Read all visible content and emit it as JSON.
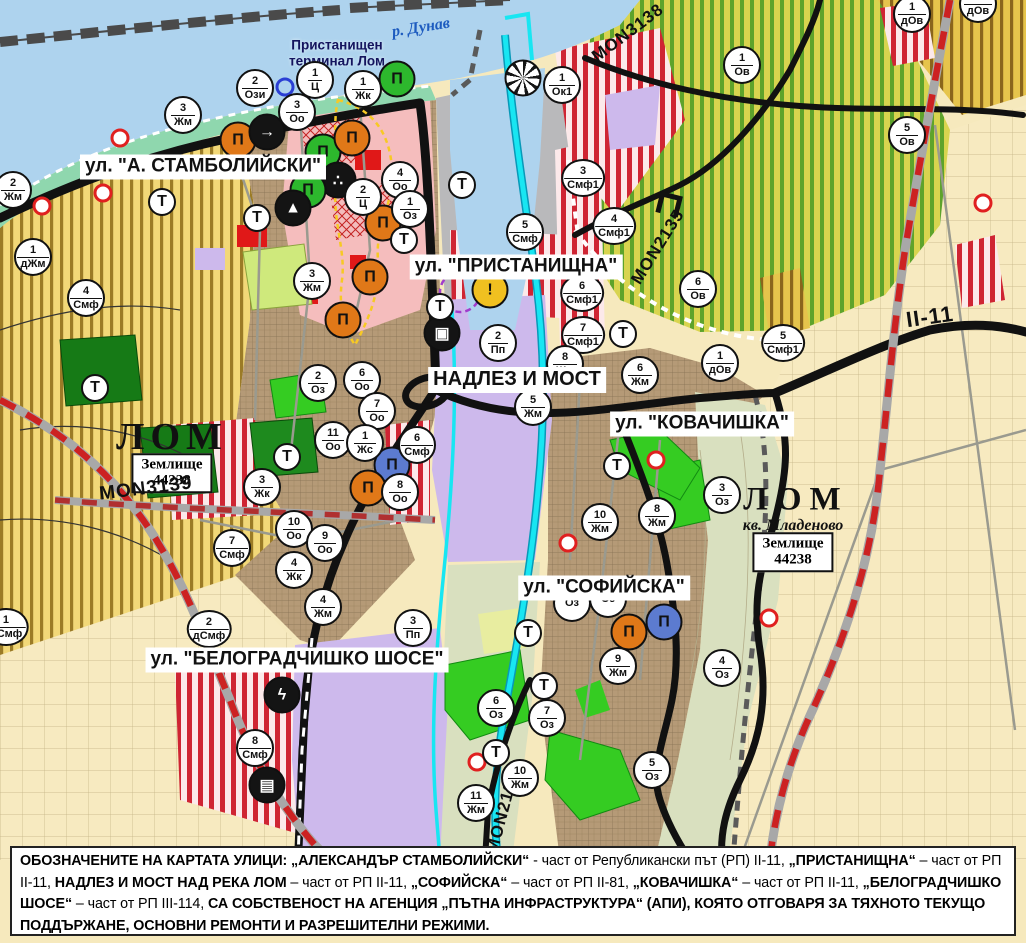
{
  "map_title": "Устройствен план – гр. Лом",
  "rivers": {
    "danube_label": "р. Дунав",
    "port_label": "Пристанищен\nтерминал Лом"
  },
  "street_labels": [
    {
      "text": "ул. \"А. СТАМБОЛИЙСКИ\"",
      "x": 203,
      "y": 167,
      "fs": 19
    },
    {
      "text": "ул. \"ПРИСТАНИЩНА\"",
      "x": 516,
      "y": 267,
      "fs": 19
    },
    {
      "text": "НАДЛЕЗ И МОСТ",
      "x": 517,
      "y": 380,
      "fs": 20
    },
    {
      "text": "ул. \"КОВАЧИШКА\"",
      "x": 702,
      "y": 424,
      "fs": 19
    },
    {
      "text": "ул. \"СОФИЙСКА\"",
      "x": 604,
      "y": 588,
      "fs": 19
    },
    {
      "text": "ул. \"БЕЛОГРАДЧИШКО ШОСЕ\"",
      "x": 297,
      "y": 660,
      "fs": 19
    }
  ],
  "road_labels": [
    {
      "text": "MON3138",
      "x": 628,
      "y": 33,
      "rot": -37,
      "fs": 17
    },
    {
      "text": "MON3139",
      "x": 146,
      "y": 489,
      "rot": -7,
      "fs": 19
    },
    {
      "text": "MON2135",
      "x": 658,
      "y": 247,
      "rot": -58,
      "fs": 17
    },
    {
      "text": "MON2136",
      "x": 503,
      "y": 812,
      "rot": -75,
      "fs": 17
    },
    {
      "text": "II-11",
      "x": 930,
      "y": 317,
      "rot": -8,
      "fs": 22
    }
  ],
  "place_labels": {
    "cities": [
      {
        "text": "ЛОМ",
        "x": 172,
        "y": 437,
        "fs": 38,
        "ls": 6
      },
      {
        "text": "ЛОМ",
        "x": 796,
        "y": 500,
        "fs": 33,
        "ls": 8
      }
    ],
    "districts": [
      {
        "text": "кв. Младеново",
        "x": 793,
        "y": 526,
        "fs": 16
      }
    ],
    "land_boxes": [
      {
        "line1": "Землище",
        "line2": "44238",
        "x": 172,
        "y": 473
      },
      {
        "line1": "Землище",
        "line2": "44238",
        "x": 793,
        "y": 552
      }
    ],
    "river": {
      "x": 421,
      "y": 28,
      "rot": -9,
      "fs": 16
    },
    "port": {
      "x": 337,
      "y": 53
    }
  },
  "zone_markers": [
    [
      255,
      88,
      "2",
      "Ози"
    ],
    [
      315,
      80,
      "1",
      "Ц"
    ],
    [
      297,
      112,
      "3",
      "Оо"
    ],
    [
      363,
      89,
      "1",
      "Жк"
    ],
    [
      562,
      85,
      "1",
      "Ок1"
    ],
    [
      742,
      65,
      "1",
      "Ов"
    ],
    [
      912,
      14,
      "1",
      "дОв"
    ],
    [
      978,
      4,
      "1",
      "дОв"
    ],
    [
      183,
      115,
      "3",
      "Жм"
    ],
    [
      13,
      190,
      "2",
      "Жм"
    ],
    [
      33,
      257,
      "1",
      "дЖм"
    ],
    [
      312,
      281,
      "3",
      "Жм"
    ],
    [
      907,
      135,
      "5",
      "Ов"
    ],
    [
      400,
      180,
      "4",
      "Оо"
    ],
    [
      363,
      197,
      "2",
      "Ц"
    ],
    [
      410,
      209,
      "1",
      "Оз"
    ],
    [
      525,
      232,
      "5",
      "Смф"
    ],
    [
      583,
      178,
      "3",
      "Смф1"
    ],
    [
      614,
      226,
      "4",
      "Смф1"
    ],
    [
      582,
      293,
      "6",
      "Смф1"
    ],
    [
      583,
      335,
      "7",
      "Смф1"
    ],
    [
      698,
      289,
      "6",
      "Ов"
    ],
    [
      720,
      363,
      "1",
      "дОв"
    ],
    [
      783,
      343,
      "5",
      "Смф1"
    ],
    [
      318,
      383,
      "2",
      "Оз"
    ],
    [
      362,
      380,
      "6",
      "Оо"
    ],
    [
      377,
      411,
      "7",
      "Оо"
    ],
    [
      333,
      440,
      "11",
      "Оо"
    ],
    [
      365,
      443,
      "1",
      "Жс"
    ],
    [
      417,
      445,
      "6",
      "Смф"
    ],
    [
      400,
      492,
      "8",
      "Оо"
    ],
    [
      262,
      487,
      "3",
      "Жк"
    ],
    [
      294,
      529,
      "10",
      "Оо"
    ],
    [
      325,
      543,
      "9",
      "Оо"
    ],
    [
      294,
      570,
      "4",
      "Жк"
    ],
    [
      323,
      607,
      "4",
      "Жм"
    ],
    [
      209,
      629,
      "2",
      "дСмф"
    ],
    [
      413,
      628,
      "3",
      "Пп"
    ],
    [
      255,
      748,
      "8",
      "Смф"
    ],
    [
      86,
      298,
      "4",
      "Смф"
    ],
    [
      232,
      548,
      "7",
      "Смф"
    ],
    [
      6,
      627,
      "1",
      "дСмф"
    ],
    [
      498,
      343,
      "2",
      "Пп"
    ],
    [
      533,
      407,
      "5",
      "Жм"
    ],
    [
      565,
      364,
      "8",
      "Жм"
    ],
    [
      640,
      375,
      "6",
      "Жм"
    ],
    [
      722,
      495,
      "3",
      "Оз"
    ],
    [
      657,
      516,
      "8",
      "Жм"
    ],
    [
      600,
      522,
      "10",
      "Жм"
    ],
    [
      618,
      666,
      "9",
      "Жм"
    ],
    [
      722,
      668,
      "4",
      "Оз"
    ],
    [
      572,
      603,
      "",
      "Оз"
    ],
    [
      608,
      599,
      "",
      "Оз"
    ],
    [
      496,
      708,
      "6",
      "Оз"
    ],
    [
      547,
      718,
      "7",
      "Оз"
    ],
    [
      520,
      778,
      "10",
      "Жм"
    ],
    [
      476,
      803,
      "11",
      "Жм"
    ],
    [
      652,
      770,
      "5",
      "Оз"
    ]
  ],
  "t_markers": [
    [
      162,
      202
    ],
    [
      257,
      218
    ],
    [
      404,
      240
    ],
    [
      95,
      388
    ],
    [
      287,
      457
    ],
    [
      462,
      185
    ],
    [
      440,
      307
    ],
    [
      623,
      334
    ],
    [
      617,
      466
    ],
    [
      528,
      633
    ],
    [
      544,
      686
    ],
    [
      496,
      753
    ]
  ],
  "poi_icons": [
    {
      "x": 238,
      "y": 140,
      "bg": "#e07818",
      "fg": "#111",
      "glyph": "Π",
      "name": "monument-icon"
    },
    {
      "x": 267,
      "y": 132,
      "bg": "#141414",
      "fg": "#fff",
      "glyph": "→",
      "name": "direction-icon"
    },
    {
      "x": 323,
      "y": 152,
      "bg": "#2db82d",
      "fg": "#111",
      "glyph": "Π",
      "name": "monument-icon"
    },
    {
      "x": 352,
      "y": 138,
      "bg": "#e07818",
      "fg": "#111",
      "glyph": "Π",
      "name": "monument-icon"
    },
    {
      "x": 338,
      "y": 180,
      "bg": "#141414",
      "fg": "#fff",
      "glyph": "∴",
      "name": "memorial-icon"
    },
    {
      "x": 308,
      "y": 190,
      "bg": "#2db82d",
      "fg": "#111",
      "glyph": "Π",
      "name": "monument-icon"
    },
    {
      "x": 293,
      "y": 208,
      "bg": "#141414",
      "fg": "#fff",
      "glyph": "▲",
      "name": "cave-icon"
    },
    {
      "x": 383,
      "y": 223,
      "bg": "#e07818",
      "fg": "#111",
      "glyph": "Π",
      "name": "monument-icon"
    },
    {
      "x": 370,
      "y": 277,
      "bg": "#e07818",
      "fg": "#111",
      "glyph": "Π",
      "name": "monument-icon"
    },
    {
      "x": 343,
      "y": 320,
      "bg": "#e07818",
      "fg": "#111",
      "glyph": "Π",
      "name": "monument-icon"
    },
    {
      "x": 397,
      "y": 79,
      "bg": "#2db82d",
      "fg": "#111",
      "glyph": "Π",
      "name": "monument-icon"
    },
    {
      "x": 523,
      "y": 78,
      "bg": "#ffffff",
      "fg": "#111",
      "glyph": "",
      "radial": true,
      "name": "sunburst-monument-icon"
    },
    {
      "x": 392,
      "y": 465,
      "bg": "#5c7bd0",
      "fg": "#111",
      "glyph": "Π",
      "name": "museum-icon"
    },
    {
      "x": 368,
      "y": 488,
      "bg": "#e07818",
      "fg": "#111",
      "glyph": "Π",
      "name": "monument-icon"
    },
    {
      "x": 629,
      "y": 632,
      "bg": "#e07818",
      "fg": "#111",
      "glyph": "Π",
      "name": "monument-icon"
    },
    {
      "x": 664,
      "y": 622,
      "bg": "#5c7bd0",
      "fg": "#111",
      "glyph": "Π",
      "name": "museum-icon"
    },
    {
      "x": 442,
      "y": 333,
      "bg": "#141414",
      "fg": "#fff",
      "glyph": "▣",
      "name": "bus-terminal-icon"
    },
    {
      "x": 490,
      "y": 290,
      "bg": "#f0c020",
      "fg": "#111",
      "glyph": "!",
      "name": "warning-icon"
    },
    {
      "x": 282,
      "y": 695,
      "bg": "#141414",
      "fg": "#fff",
      "glyph": "ϟ",
      "name": "power-substation-icon"
    },
    {
      "x": 267,
      "y": 785,
      "bg": "#141414",
      "fg": "#fff",
      "glyph": "▤",
      "name": "railway-station-icon"
    }
  ],
  "small_rings": [
    {
      "x": 285,
      "y": 87,
      "color": "#2b3fd4",
      "size": 13
    }
  ],
  "red_dots": [
    [
      120,
      138
    ],
    [
      103,
      193
    ],
    [
      42,
      206
    ],
    [
      983,
      203
    ],
    [
      656,
      460
    ],
    [
      477,
      762
    ],
    [
      769,
      618
    ],
    [
      568,
      543
    ]
  ],
  "zone_colors": {
    "residential_Жм": "#b59a77",
    "central_Ц": "#f5bdbd",
    "mixed_Смф_stripes": "#cf2533",
    "production_Пп": "#cdb9ec",
    "greenery_Оз": "#35cc22",
    "forest": "#167a16",
    "vineyards_Ов": "#5ea32b",
    "arable_land": "#f2d878",
    "fields": "#f7eac0",
    "water": "#aed3ee",
    "river_lom": "#18e6f2",
    "main_road": "#111111",
    "republican_road_dash": "#cc2222"
  },
  "footer": {
    "segments": [
      {
        "b": 1,
        "t": "ОБОЗНАЧЕНИТЕ НА КАРТАТА УЛИЦИ: „АЛЕКСАНДЪР СТАМБОЛИЙСКИ“"
      },
      {
        "b": 0,
        "t": " - част от Републикански път (РП) II-11, "
      },
      {
        "b": 1,
        "t": "„ПРИСТАНИЩНА“"
      },
      {
        "b": 0,
        "t": " – част от РП II-11, "
      },
      {
        "b": 1,
        "t": "НАДЛЕЗ И МОСТ НАД РЕКА ЛОМ"
      },
      {
        "b": 0,
        "t": " – част от РП II-11, "
      },
      {
        "b": 1,
        "t": "„СОФИЙСКА“"
      },
      {
        "b": 0,
        "t": " – част от РП II-81, "
      },
      {
        "b": 1,
        "t": "„КОВАЧИШКА“"
      },
      {
        "b": 0,
        "t": " – част от РП II-11, "
      },
      {
        "b": 1,
        "t": "„БЕЛОГРАДЧИШКО ШОСЕ“"
      },
      {
        "b": 0,
        "t": " – част от РП III-114, "
      },
      {
        "b": 1,
        "t": "СА СОБСТВЕНОСТ НА АГЕНЦИЯ „ПЪТНА ИНФРАСТРУКТУРА“ (АПИ), КОЯТО ОТГОВАРЯ ЗА ТЯХНОТО ТЕКУЩО ПОДДЪРЖАНЕ, ОСНОВНИ РЕМОНТИ И РАЗРЕШИТЕЛНИ РЕЖИМИ."
      }
    ]
  }
}
